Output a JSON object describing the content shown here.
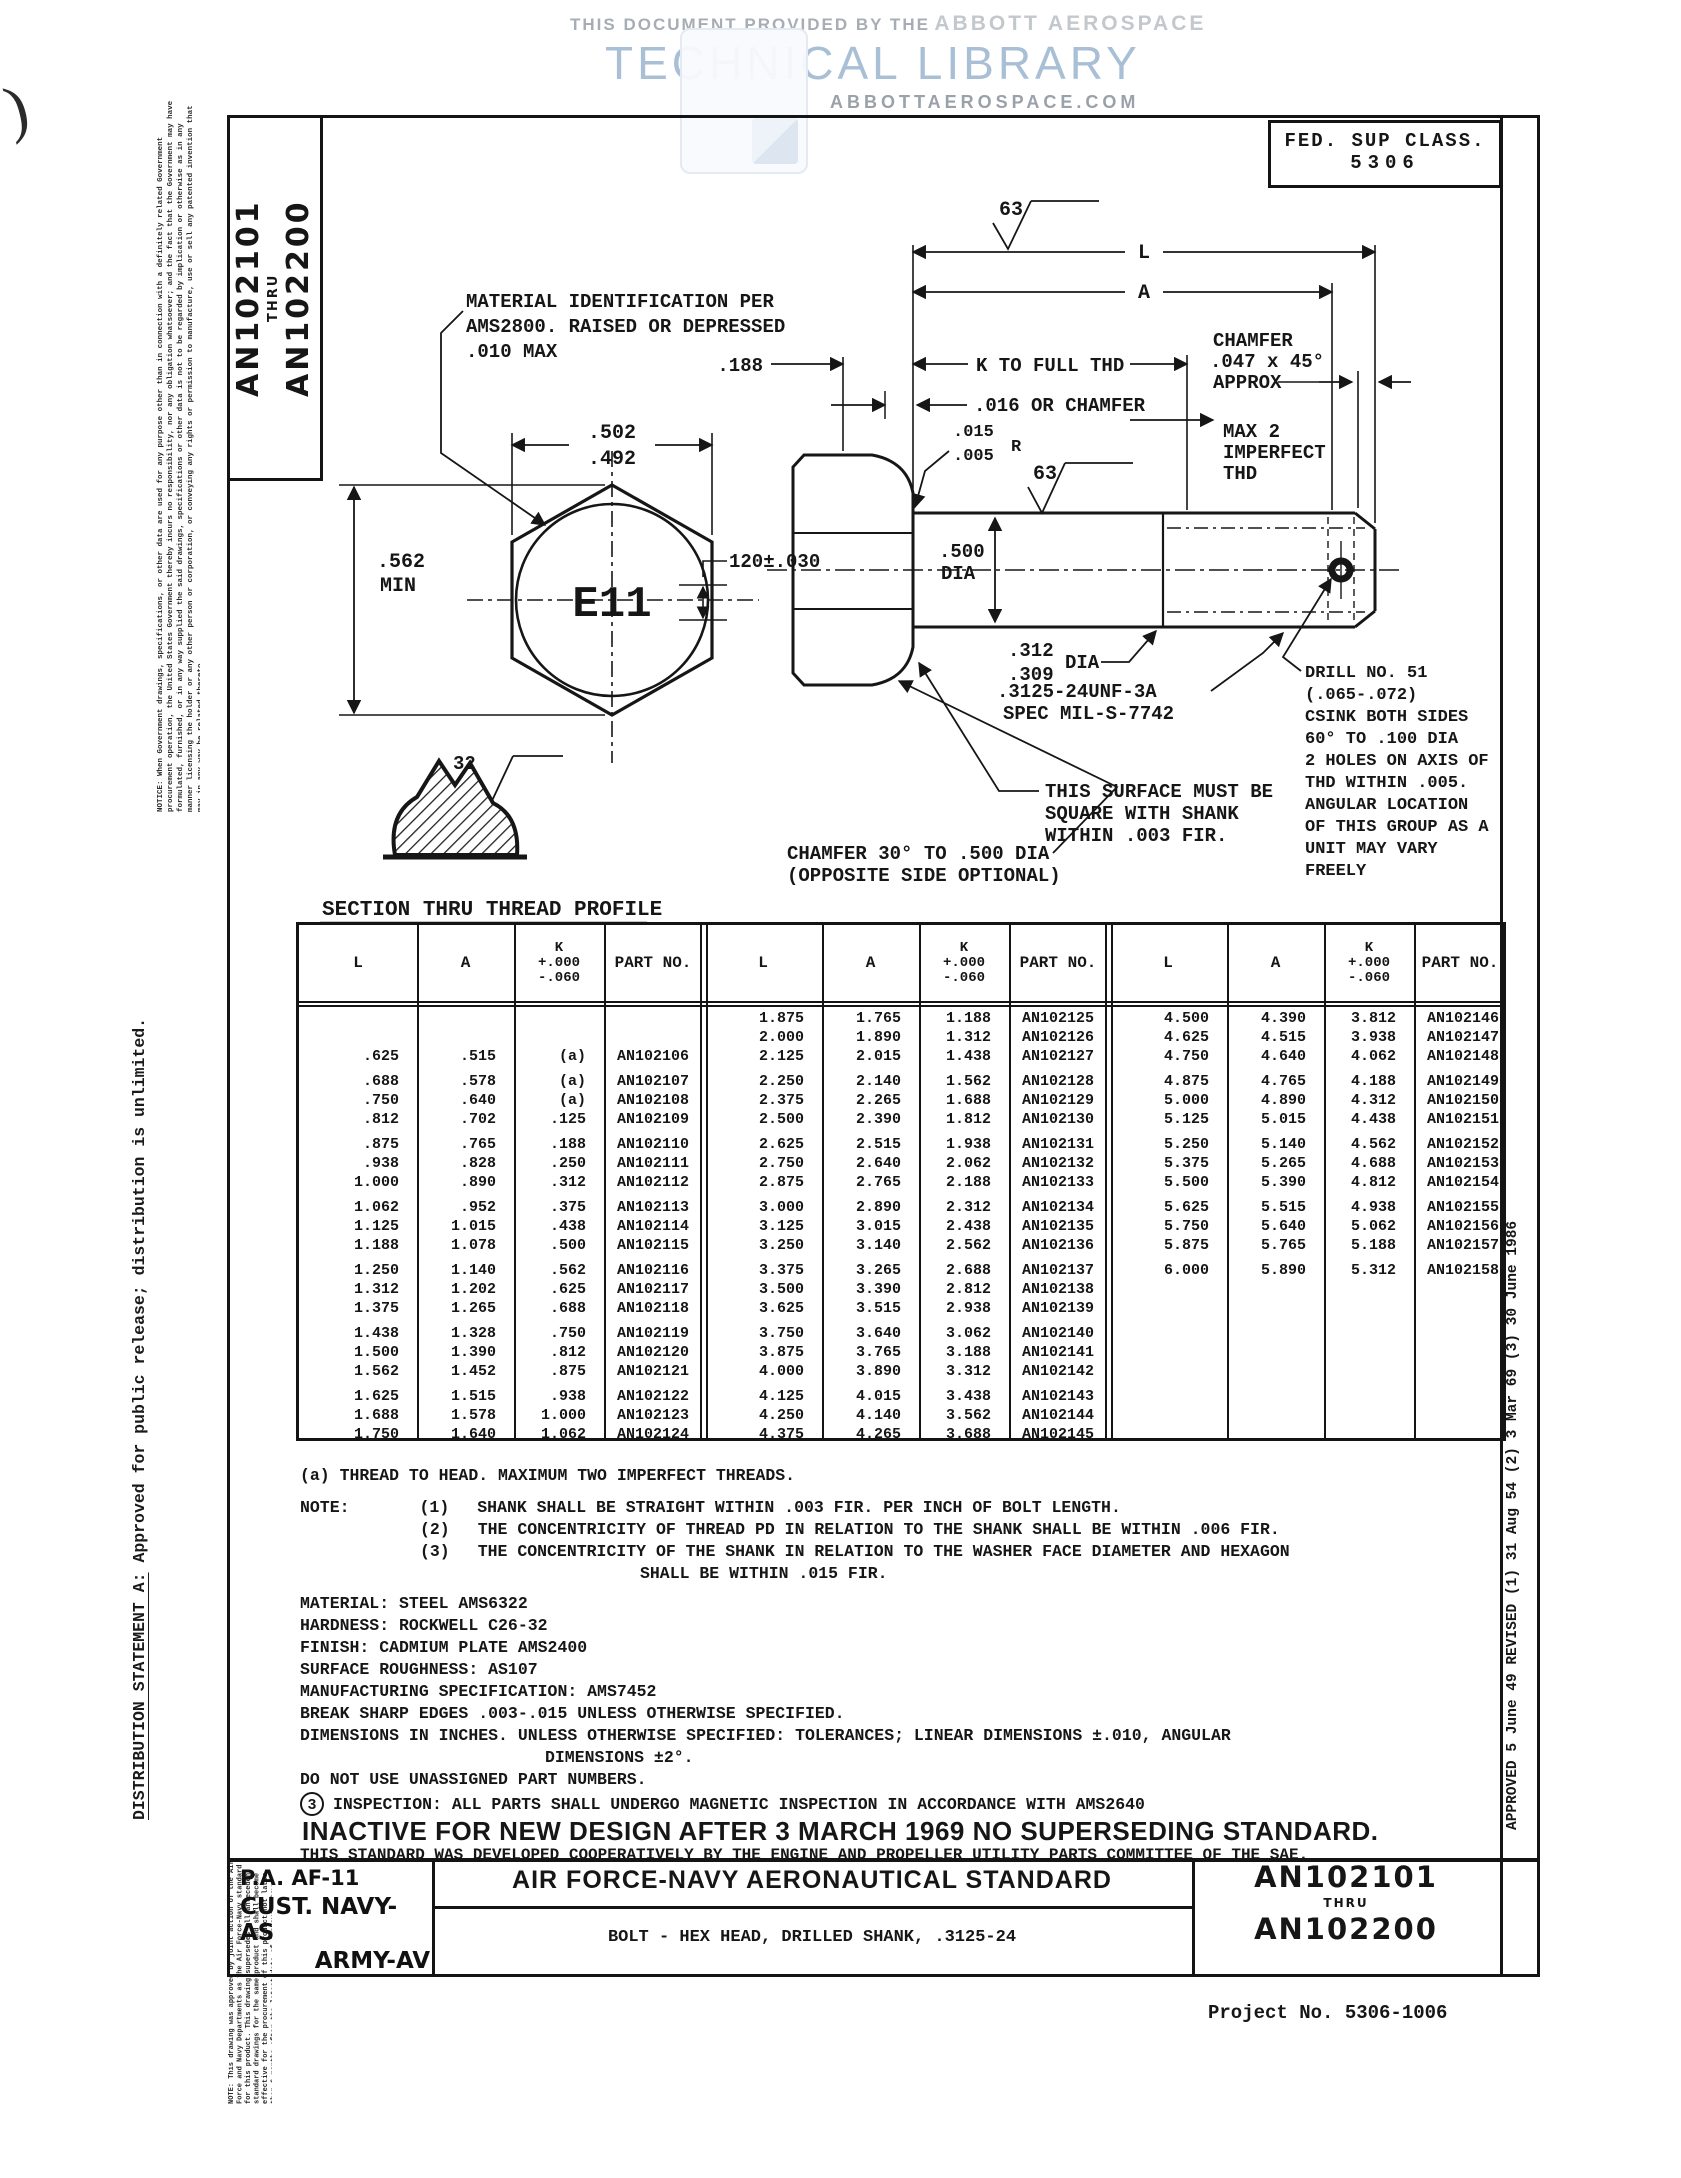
{
  "watermark": {
    "line1a": "THIS DOCUMENT PROVIDED BY THE",
    "line1b": "ABBOTT AEROSPACE",
    "line2": "TECHNICAL LIBRARY",
    "line3": "ABBOTTAEROSPACE.COM"
  },
  "page_margins": {
    "pen_mark": ")",
    "notice": "NOTICE: When Government drawings, specifications, or other data are used for any purpose other than in connection with a definitely related Government procurement operation, the United States Government thereby incurs no responsibility, nor any obligation whatsoever; and the fact that the Government may have formulated, furnished, or in any way supplied the said drawings, specifications or other data is not to be regarded by implication or otherwise as in any manner licensing the holder or any other person or corporation, or conveying any rights or permission to manufacture, use or sell any patented invention that may in any way be related thereto.",
    "distribution_label": "DISTRIBUTION STATEMENT A:",
    "distribution_text": "  Approved for public release; distribution is unlimited.",
    "approval_note": "NOTE: This drawing was approved by joint action of the Air Force and Navy Departments as the Air Force-Navy standard for this product. This drawing supersedes all antecedent standard drawings for the same product and shall become effective for the procurement of this product not later than 6 months after the latest date of approval shown.",
    "revision_history": "APPROVED 5 June 49   REVISED (1) 31 Aug 54  (2) 3 Mar 69  (3) 30 June 1986"
  },
  "header": {
    "an_top": "AN102101",
    "an_thru": "THRU",
    "an_bottom": "AN102200",
    "fed_line1": "FED. SUP CLASS.",
    "fed_line2": "5306"
  },
  "drawing": {
    "callouts": {
      "material_lines": [
        "MATERIAL IDENTIFICATION PER",
        "AMS2800.  RAISED OR DEPRESSED",
        ".010 MAX"
      ],
      "dim_across_flats": [
        ".502",
        ".492"
      ],
      "dim_head_height": [
        ".562",
        "MIN"
      ],
      "head_marking": "E11",
      "dim_marking_size": "120±.030",
      "dim_188": ".188",
      "k_to_full_thd": "K TO FULL THD",
      "washer_face": ".016 OR CHAMFER",
      "chamfer_lines": [
        "CHAMFER",
        ".047 x 45°",
        "APPROX"
      ],
      "imperfect_lines": [
        "MAX 2",
        "IMPERFECT",
        "THD"
      ],
      "length_l": "L",
      "length_a": "A",
      "finish_63": "63",
      "fillet_radius": [
        ".015",
        ".005",
        "R"
      ],
      "shank_dia": [
        ".500",
        "DIA"
      ],
      "hole_dia": [
        ".312",
        ".309",
        "DIA"
      ],
      "thread_spec": [
        ".3125-24UNF-3A",
        "SPEC MIL-S-7742"
      ],
      "square_lines": [
        "THIS SURFACE MUST BE",
        "SQUARE WITH SHANK",
        "WITHIN .003 FIR."
      ],
      "drill_lines": [
        "DRILL NO. 51",
        "(.065-.072)",
        "CSINK BOTH SIDES",
        "60° TO .100 DIA",
        "2 HOLES ON AXIS OF",
        "THD WITHIN .005.",
        "ANGULAR LOCATION",
        "OF THIS GROUP AS A",
        "UNIT MAY VARY",
        "FREELY"
      ],
      "chamfer30_lines": [
        "CHAMFER 30° TO .500 DIA",
        "(OPPOSITE SIDE OPTIONAL)"
      ],
      "finish_32": "32",
      "section_label": "SECTION THRU THREAD PROFILE"
    }
  },
  "table": {
    "headers": {
      "l": "L",
      "a": "A",
      "k1": "K",
      "k2": "+.000",
      "k3": "-.060",
      "part": "PART NO."
    },
    "blocks": [
      [
        [
          [
            "",
            "",
            "",
            ""
          ],
          [
            "",
            "",
            "",
            ""
          ],
          [
            ".625",
            ".515",
            "(a)",
            "AN102106"
          ]
        ],
        [
          [
            ".688",
            ".578",
            "(a)",
            "AN102107"
          ],
          [
            ".750",
            ".640",
            "(a)",
            "AN102108"
          ],
          [
            ".812",
            ".702",
            ".125",
            "AN102109"
          ]
        ],
        [
          [
            ".875",
            ".765",
            ".188",
            "AN102110"
          ],
          [
            ".938",
            ".828",
            ".250",
            "AN102111"
          ],
          [
            "1.000",
            ".890",
            ".312",
            "AN102112"
          ]
        ],
        [
          [
            "1.062",
            ".952",
            ".375",
            "AN102113"
          ],
          [
            "1.125",
            "1.015",
            ".438",
            "AN102114"
          ],
          [
            "1.188",
            "1.078",
            ".500",
            "AN102115"
          ]
        ],
        [
          [
            "1.250",
            "1.140",
            ".562",
            "AN102116"
          ],
          [
            "1.312",
            "1.202",
            ".625",
            "AN102117"
          ],
          [
            "1.375",
            "1.265",
            ".688",
            "AN102118"
          ]
        ],
        [
          [
            "1.438",
            "1.328",
            ".750",
            "AN102119"
          ],
          [
            "1.500",
            "1.390",
            ".812",
            "AN102120"
          ],
          [
            "1.562",
            "1.452",
            ".875",
            "AN102121"
          ]
        ],
        [
          [
            "1.625",
            "1.515",
            ".938",
            "AN102122"
          ],
          [
            "1.688",
            "1.578",
            "1.000",
            "AN102123"
          ],
          [
            "1.750",
            "1.640",
            "1.062",
            "AN102124"
          ]
        ]
      ],
      [
        [
          [
            "1.875",
            "1.765",
            "1.188",
            "AN102125"
          ],
          [
            "2.000",
            "1.890",
            "1.312",
            "AN102126"
          ],
          [
            "2.125",
            "2.015",
            "1.438",
            "AN102127"
          ]
        ],
        [
          [
            "2.250",
            "2.140",
            "1.562",
            "AN102128"
          ],
          [
            "2.375",
            "2.265",
            "1.688",
            "AN102129"
          ],
          [
            "2.500",
            "2.390",
            "1.812",
            "AN102130"
          ]
        ],
        [
          [
            "2.625",
            "2.515",
            "1.938",
            "AN102131"
          ],
          [
            "2.750",
            "2.640",
            "2.062",
            "AN102132"
          ],
          [
            "2.875",
            "2.765",
            "2.188",
            "AN102133"
          ]
        ],
        [
          [
            "3.000",
            "2.890",
            "2.312",
            "AN102134"
          ],
          [
            "3.125",
            "3.015",
            "2.438",
            "AN102135"
          ],
          [
            "3.250",
            "3.140",
            "2.562",
            "AN102136"
          ]
        ],
        [
          [
            "3.375",
            "3.265",
            "2.688",
            "AN102137"
          ],
          [
            "3.500",
            "3.390",
            "2.812",
            "AN102138"
          ],
          [
            "3.625",
            "3.515",
            "2.938",
            "AN102139"
          ]
        ],
        [
          [
            "3.750",
            "3.640",
            "3.062",
            "AN102140"
          ],
          [
            "3.875",
            "3.765",
            "3.188",
            "AN102141"
          ],
          [
            "4.000",
            "3.890",
            "3.312",
            "AN102142"
          ]
        ],
        [
          [
            "4.125",
            "4.015",
            "3.438",
            "AN102143"
          ],
          [
            "4.250",
            "4.140",
            "3.562",
            "AN102144"
          ],
          [
            "4.375",
            "4.265",
            "3.688",
            "AN102145"
          ]
        ]
      ],
      [
        [
          [
            "4.500",
            "4.390",
            "3.812",
            "AN102146"
          ],
          [
            "4.625",
            "4.515",
            "3.938",
            "AN102147"
          ],
          [
            "4.750",
            "4.640",
            "4.062",
            "AN102148"
          ]
        ],
        [
          [
            "4.875",
            "4.765",
            "4.188",
            "AN102149"
          ],
          [
            "5.000",
            "4.890",
            "4.312",
            "AN102150"
          ],
          [
            "5.125",
            "5.015",
            "4.438",
            "AN102151"
          ]
        ],
        [
          [
            "5.250",
            "5.140",
            "4.562",
            "AN102152"
          ],
          [
            "5.375",
            "5.265",
            "4.688",
            "AN102153"
          ],
          [
            "5.500",
            "5.390",
            "4.812",
            "AN102154"
          ]
        ],
        [
          [
            "5.625",
            "5.515",
            "4.938",
            "AN102155"
          ],
          [
            "5.750",
            "5.640",
            "5.062",
            "AN102156"
          ],
          [
            "5.875",
            "5.765",
            "5.188",
            "AN102157"
          ]
        ],
        [
          [
            "6.000",
            "5.890",
            "5.312",
            "AN102158"
          ]
        ]
      ]
    ]
  },
  "notes": {
    "thread_note": "(a)  THREAD TO HEAD.  MAXIMUM TWO IMPERFECT THREADS.",
    "note_label": "NOTE:",
    "n1_num": "(1)",
    "n1": "SHANK SHALL BE STRAIGHT WITHIN .003 FIR. PER INCH OF BOLT LENGTH.",
    "n2_num": "(2)",
    "n2": "THE CONCENTRICITY OF THREAD PD IN RELATION TO THE SHANK SHALL BE WITHIN .006 FIR.",
    "n3_num": "(3)",
    "n3": "THE CONCENTRICITY OF THE SHANK IN RELATION TO THE WASHER FACE DIAMETER AND HEXAGON",
    "n3_cont": "SHALL BE WITHIN .015 FIR.",
    "material": "MATERIAL:  STEEL AMS6322",
    "hardness": "HARDNESS:  ROCKWELL C26-32",
    "finish": "FINISH:  CADMIUM PLATE AMS2400",
    "surface": "SURFACE ROUGHNESS:  AS107",
    "manufacturing": "MANUFACTURING SPECIFICATION:  AMS7452",
    "break_edges": "BREAK SHARP EDGES .003-.015 UNLESS OTHERWISE SPECIFIED.",
    "dims1": "DIMENSIONS IN INCHES.  UNLESS OTHERWISE SPECIFIED:  TOLERANCES; LINEAR DIMENSIONS ±.010, ANGULAR",
    "dims2": "DIMENSIONS ±2°.",
    "unassigned": "DO NOT USE UNASSIGNED PART NUMBERS.",
    "inspection_num": "3",
    "inspection": "INSPECTION: ALL PARTS SHALL UNDERGO MAGNETIC INSPECTION IN ACCORDANCE WITH AMS2640",
    "inactive": "INACTIVE FOR NEW DESIGN AFTER 3 MARCH 1969  NO SUPERSEDING STANDARD.",
    "cooperative": "THIS STANDARD WAS DEVELOPED COOPERATIVELY BY THE ENGINE AND PROPELLER UTILITY PARTS COMMITTEE OF THE SAE."
  },
  "title_block": {
    "pa": "P.A. AF-11",
    "cust": "CUST. NAVY-AS",
    "army": "ARMY-AV",
    "standard": "AIR FORCE-NAVY AERONAUTICAL STANDARD",
    "part_title": "BOLT - HEX HEAD, DRILLED SHANK, .3125-24",
    "num_top": "AN102101",
    "thru": "THRU",
    "num_bottom": "AN102200"
  },
  "footer": {
    "project": "Project No. 5306-1006"
  }
}
